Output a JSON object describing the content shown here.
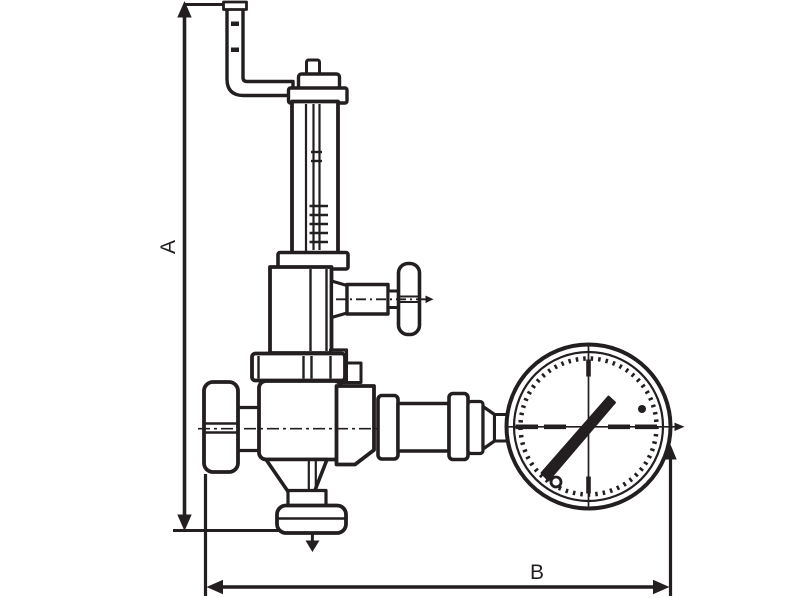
{
  "figure": {
    "background": "#ffffff",
    "ink": "#231f20",
    "dimension_labels": {
      "vertical": "A",
      "horizontal": "B"
    },
    "components": [
      "exhaust-pipe",
      "adjusting-screw",
      "sealing-cap",
      "spring-housing",
      "bonnet",
      "upper-body",
      "side-handle",
      "flange",
      "handwheel",
      "valve-body",
      "bottom-union",
      "drain-arrow",
      "outlet-connector",
      "pressure-gauge",
      "dimension-a",
      "dimension-b"
    ]
  }
}
